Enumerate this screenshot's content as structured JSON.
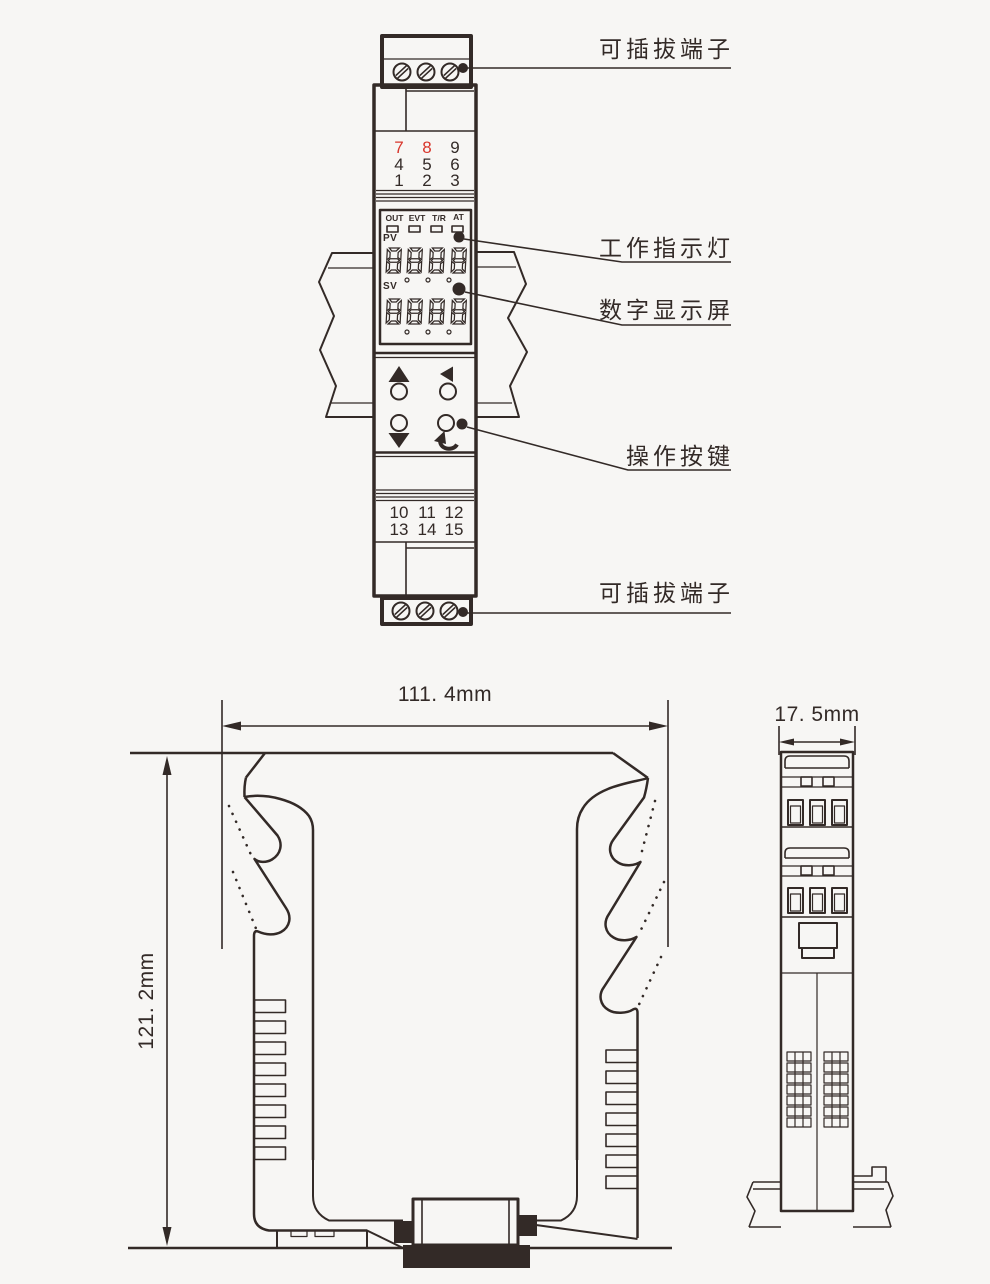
{
  "figure": {
    "background": "#f7f6f4",
    "ink": "#332a27",
    "red": "#d8352b"
  },
  "callouts": {
    "top_terminal": "可插拔端子",
    "indicator": "工作指示灯",
    "display": "数字显示屏",
    "buttons": "操作按键",
    "bottom_terminal": "可插拔端子"
  },
  "device": {
    "led_labels": [
      "OUT",
      "EVT",
      "T/R",
      "AT"
    ],
    "pv_label": "PV",
    "sv_label": "SV",
    "pv_value": "8888",
    "sv_value": "8888",
    "terminal_numbers_top": [
      [
        "7",
        "8",
        "9"
      ],
      [
        "4",
        "5",
        "6"
      ],
      [
        "1",
        "2",
        "3"
      ]
    ],
    "terminal_numbers_top_red": [
      [
        true,
        true,
        false
      ],
      [
        false,
        false,
        false
      ],
      [
        false,
        false,
        false
      ]
    ],
    "terminal_numbers_bottom": [
      [
        "10",
        "11",
        "12"
      ],
      [
        "13",
        "14",
        "15"
      ]
    ]
  },
  "dimensions": {
    "width": "111. 4mm",
    "height": "121. 2mm",
    "depth": "17. 5mm"
  }
}
